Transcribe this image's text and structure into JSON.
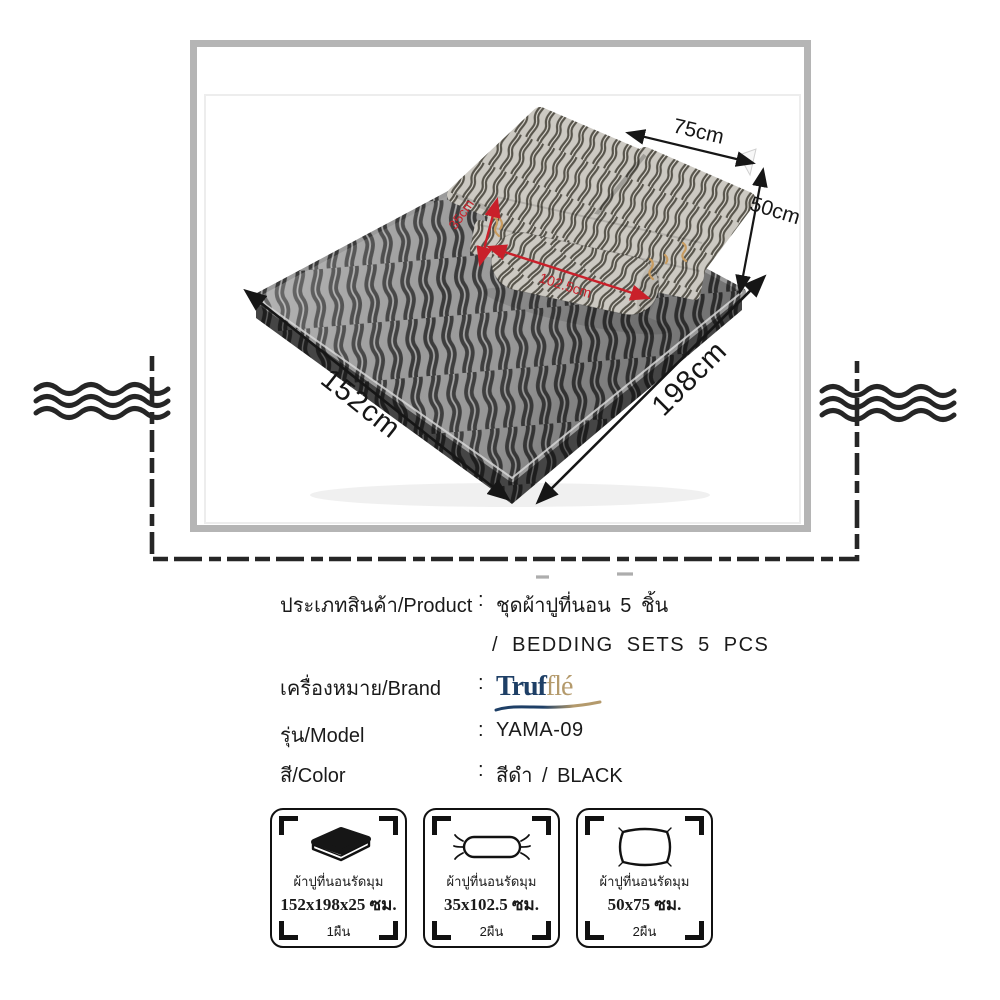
{
  "photo": {
    "dims": {
      "pillow_width": "75cm",
      "pillow_height": "50cm",
      "bed_width": "152cm",
      "bed_length": "198cm"
    },
    "red_dims": {
      "bolster_width": "35cm",
      "bolster_length": "102.5cm"
    }
  },
  "details": {
    "colon": ":",
    "product_label": "ประเภทสินค้า/Product",
    "product_value_th": "ชุดผ้าปูที่นอน 5 ชิ้น",
    "product_value_en": "/ BEDDING SETS 5 PCS",
    "brand_label": "เครื่องหมาย/Brand",
    "model_label": "รุ่น/Model",
    "model_value": "YAMA-09",
    "color_label": "สี/Color",
    "color_value": "สีดำ / BLACK"
  },
  "logo": {
    "part1": "Truf",
    "part2": "flé",
    "navy": "#1e3f66",
    "tan": "#b49a6c"
  },
  "spec_boxes": [
    {
      "label": "ผ้าปูที่นอนรัดมุม",
      "size": "152x198x25 ซม.",
      "qty": "1ผืน"
    },
    {
      "label": "ผ้าปูที่นอนรัดมุม",
      "size": "35x102.5 ซม.",
      "qty": "2ผืน"
    },
    {
      "label": "ผ้าปูที่นอนรัดมุม",
      "size": "50x75 ซม.",
      "qty": "2ผืน"
    }
  ],
  "colors": {
    "frame_gray": "#b5b5b5",
    "accent_red": "#c9202a",
    "line_dark": "#262626",
    "tie_tan": "#c89c60"
  }
}
